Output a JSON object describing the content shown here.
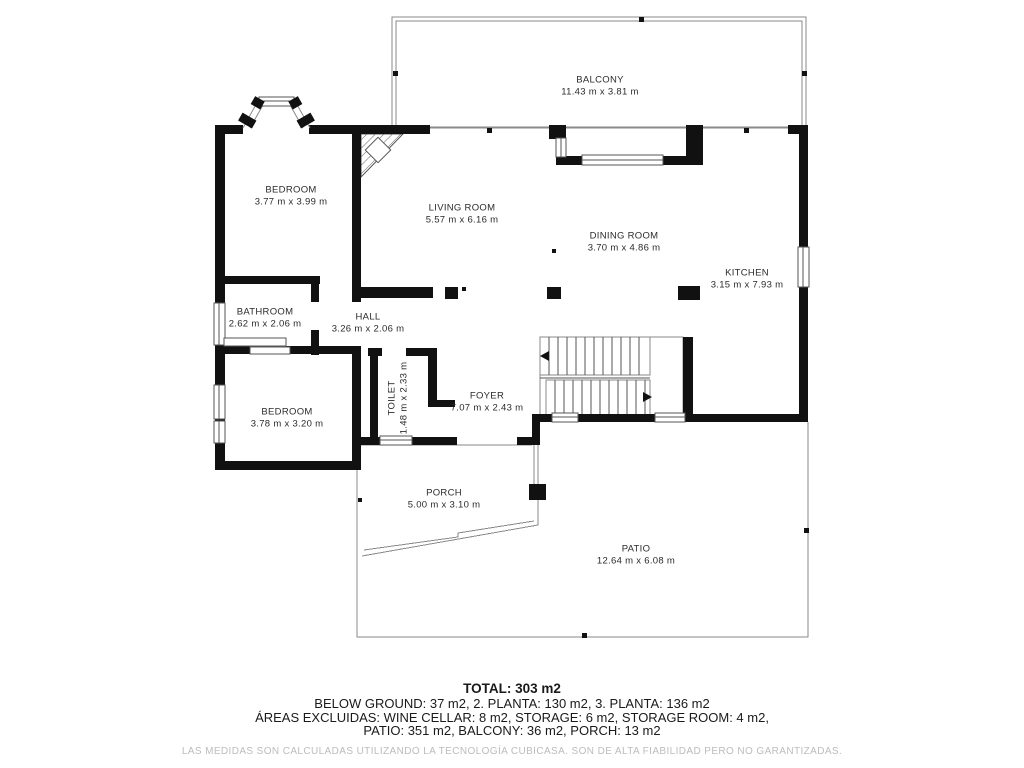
{
  "document_type": "floor-plan",
  "rooms": [
    {
      "id": "balcony",
      "name": "BALCONY",
      "dims": "11.43 m x 3.81 m"
    },
    {
      "id": "bedroom-1",
      "name": "BEDROOM",
      "dims": "3.77 m x 3.99 m"
    },
    {
      "id": "living-room",
      "name": "LIVING ROOM",
      "dims": "5.57 m x 6.16 m"
    },
    {
      "id": "dining-room",
      "name": "DINING ROOM",
      "dims": "3.70 m x 4.86 m"
    },
    {
      "id": "kitchen",
      "name": "KITCHEN",
      "dims": "3.15 m x 7.93 m"
    },
    {
      "id": "bathroom",
      "name": "BATHROOM",
      "dims": "2.62 m x 2.06 m"
    },
    {
      "id": "hall",
      "name": "HALL",
      "dims": "3.26 m x 2.06 m"
    },
    {
      "id": "toilet",
      "name": "TOILET",
      "dims": "1.48 m x 2.33 m"
    },
    {
      "id": "foyer",
      "name": "FOYER",
      "dims": "7.07 m x 2.43 m"
    },
    {
      "id": "bedroom-2",
      "name": "BEDROOM",
      "dims": "3.78 m x 3.20 m"
    },
    {
      "id": "porch",
      "name": "PORCH",
      "dims": "5.00 m x 3.10 m"
    },
    {
      "id": "patio",
      "name": "PATIO",
      "dims": "12.64 m x 6.08 m"
    }
  ],
  "summary": {
    "total": "TOTAL: 303 m2",
    "line1": "BELOW GROUND: 37 m2, 2. PLANTA: 130 m2, 3. PLANTA: 136 m2",
    "line2": "ÁREAS EXCLUIDAS: WINE CELLAR: 8 m2, STORAGE: 6 m2, STORAGE ROOM: 4 m2,",
    "line3": "PATIO: 351 m2, BALCONY: 36 m2, PORCH: 13 m2",
    "disclaimer": "LAS MEDIDAS SON CALCULADAS UTILIZANDO LA TECNOLOGÍA CUBICASA. SON DE ALTA FIABILIDAD PERO NO GARANTIZADAS."
  },
  "colors": {
    "wall": "#111111",
    "thin_line": "#8a8a8a",
    "label_text": "#2b2b2b",
    "disclaimer_text": "#bcbcbc",
    "background": "#ffffff"
  }
}
